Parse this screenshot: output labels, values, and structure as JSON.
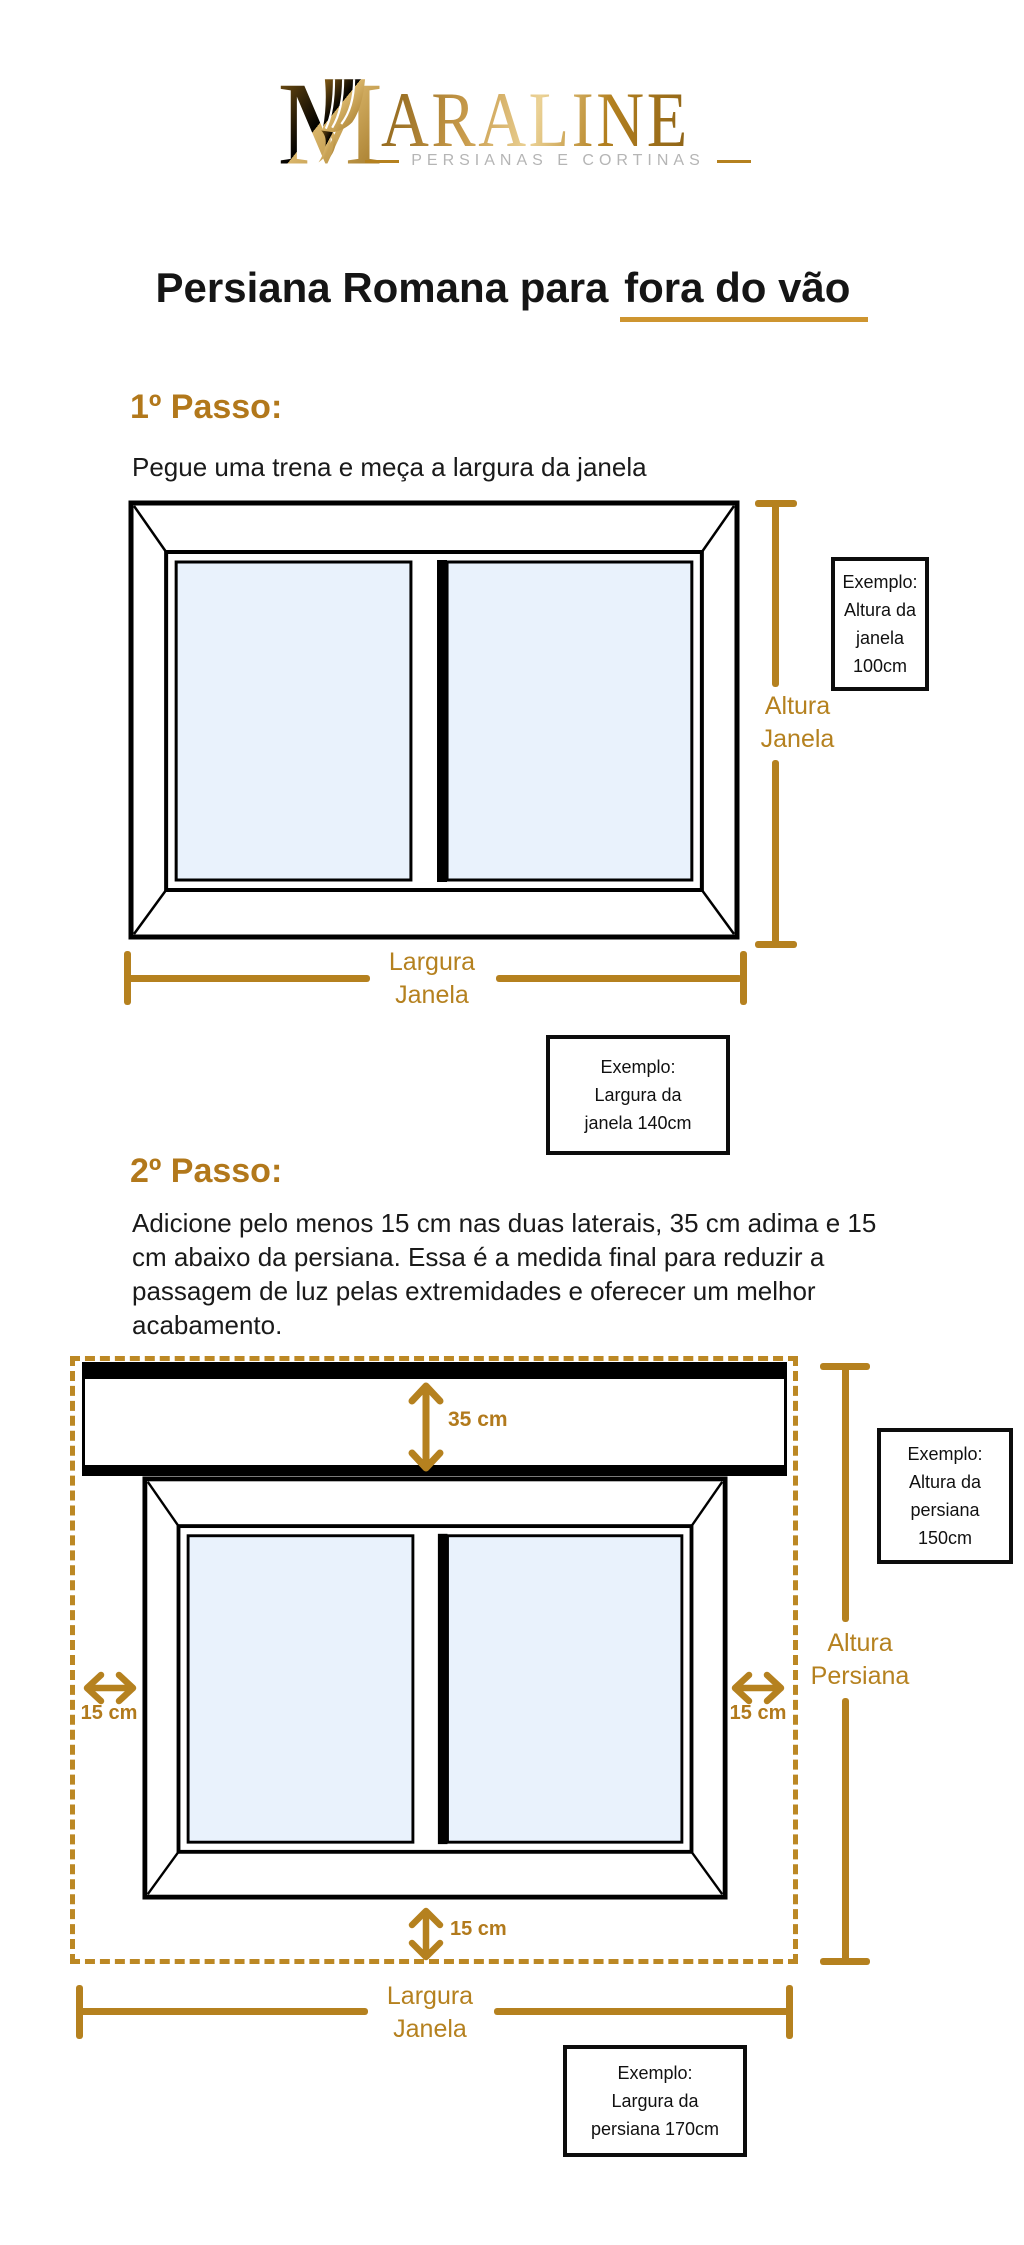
{
  "logo": {
    "brand_rest": "ARALINE",
    "subtitle": "PERSIANAS E CORTINAS"
  },
  "title": {
    "part1": "Persiana Romana para ",
    "part2_underlined": "fora do vão"
  },
  "step1": {
    "heading": "1º Passo:",
    "description": "Pegue uma trena e meça a largura da janela"
  },
  "step2": {
    "heading": "2º Passo:",
    "lines": [
      "Adicione pelo menos 15 cm nas duas laterais, 35 cm adima e 15",
      "cm abaixo da persiana. Essa é a medida final para reduzir a",
      "passagem de luz pelas extremidades e oferecer um melhor",
      "acabamento."
    ]
  },
  "diagram1": {
    "height_label": {
      "line1": "Altura",
      "line2": "Janela"
    },
    "width_label": {
      "line1": "Largura",
      "line2": "Janela"
    },
    "height_example": {
      "lines": [
        "Exemplo:",
        "Altura da",
        "janela",
        "100cm"
      ]
    },
    "width_example": {
      "lines": [
        "Exemplo:",
        "Largura da",
        "janela 140cm"
      ]
    }
  },
  "diagram2": {
    "margin_top": "35 cm",
    "margin_left": "15 cm",
    "margin_right": "15 cm",
    "margin_bottom": "15 cm",
    "height_label": {
      "line1": "Altura",
      "line2": "Persiana"
    },
    "width_label": {
      "line1": "Largura",
      "line2": "Janela"
    },
    "height_example": {
      "lines": [
        "Exemplo:",
        "Altura da",
        "persiana",
        "150cm"
      ]
    },
    "width_example": {
      "lines": [
        "Exemplo:",
        "Largura da",
        "persiana 170cm"
      ]
    }
  },
  "colors": {
    "gold": "#b5811f",
    "gold_dash": "#bc8824",
    "underline": "#ce9530",
    "glass": "#e9f2fc",
    "subtitle_gray": "#b5b5b5"
  }
}
